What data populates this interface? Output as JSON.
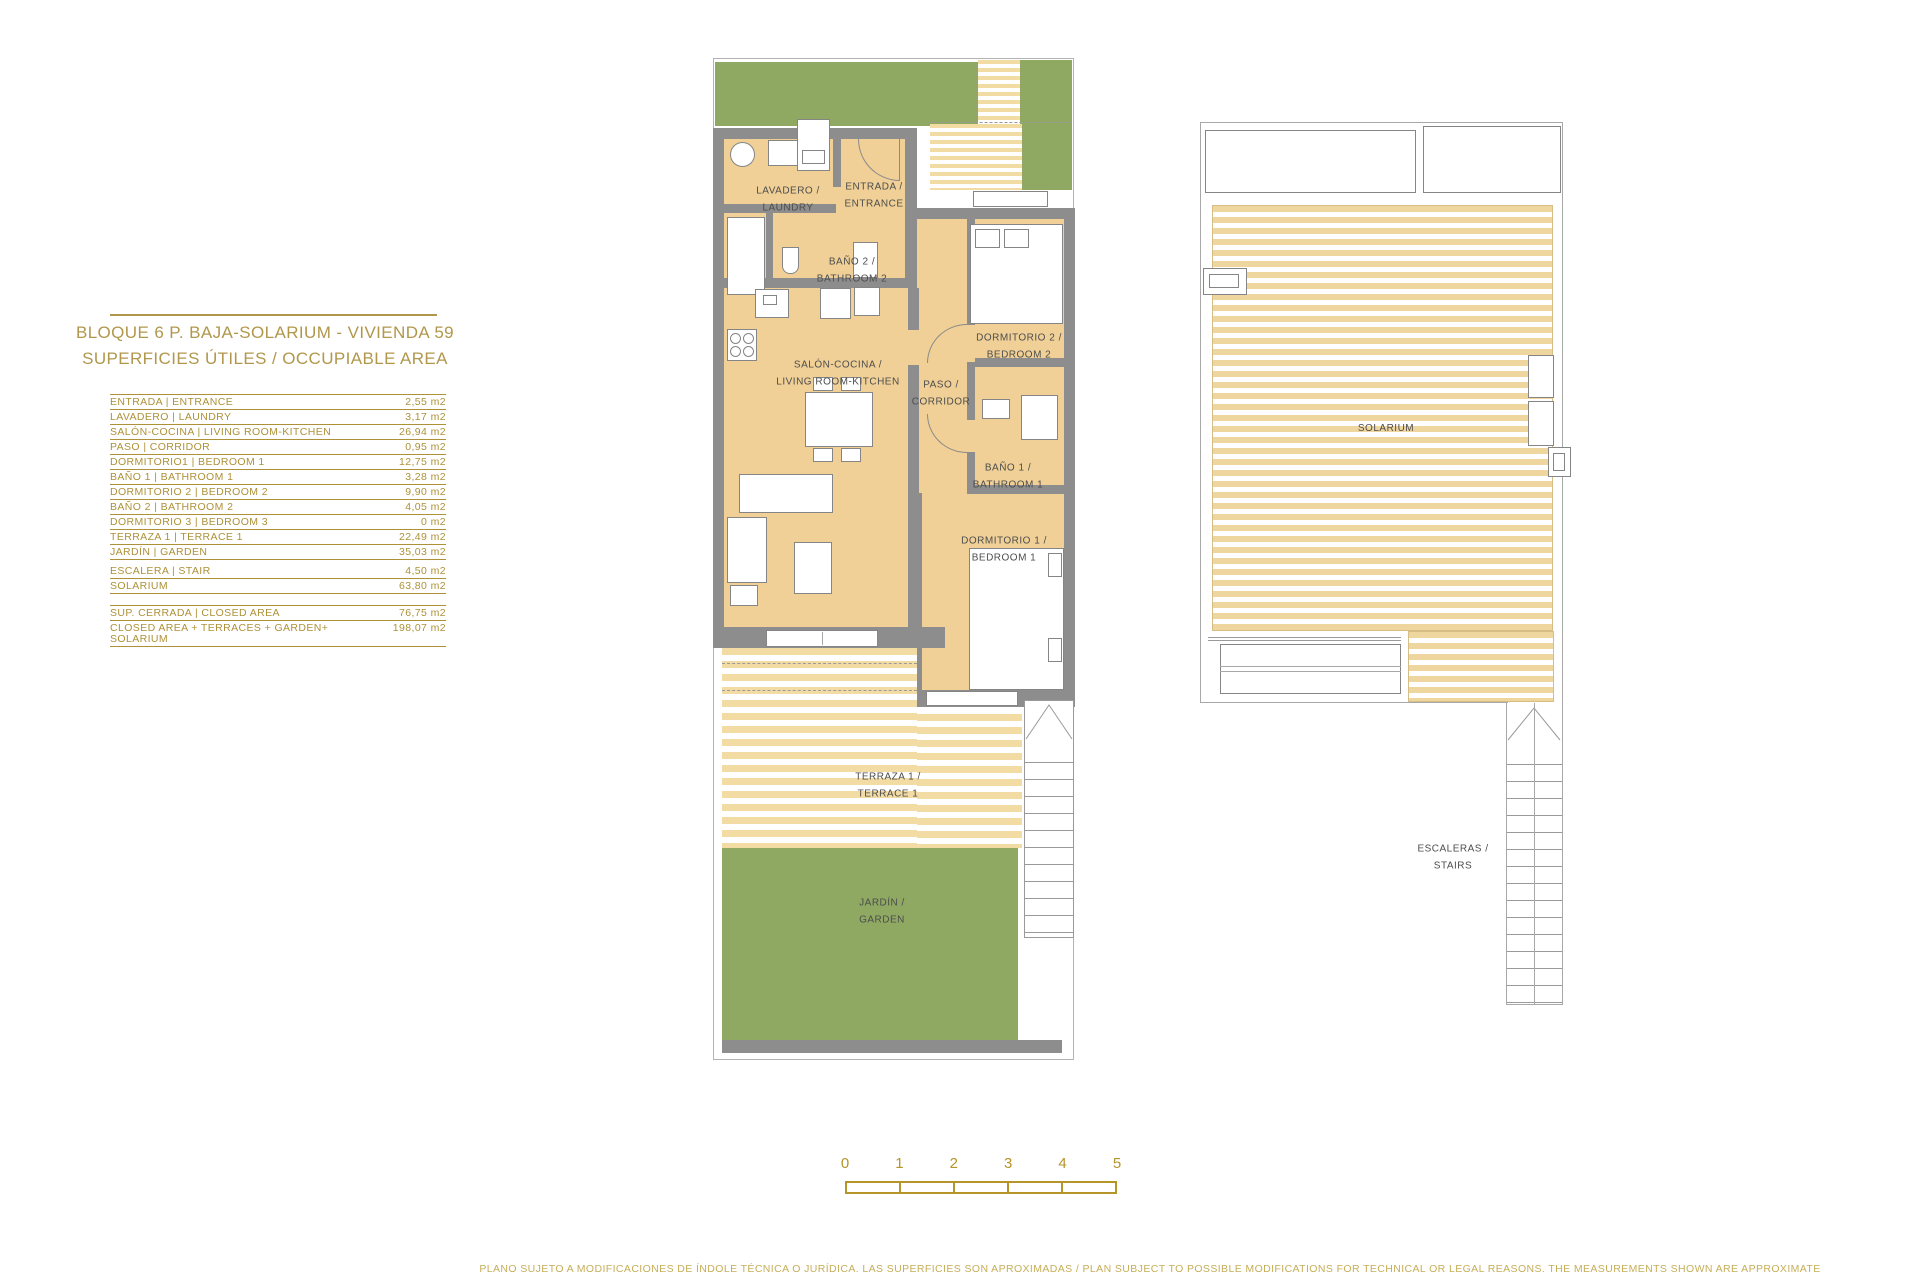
{
  "colors": {
    "gold_title": "#b1974b",
    "gold_table": "#ad9138",
    "gold_scale": "#b5942a",
    "gold_disclaimer": "#c6ae58",
    "wall_gray": "#8d8d8d",
    "floor_tan": "#f0d096",
    "garden_green": "#8fa963",
    "stripe_tan": "#f3dba4",
    "label_gray": "#4d4d4d"
  },
  "doc": {
    "title_line1": "BLOQUE 6 P. BAJA-SOLARIUM - VIVIENDA 59",
    "title_line2": "SUPERFICIES ÚTILES / OCCUPIABLE AREA",
    "disclaimer": "PLANO SUJETO A MODIFICACIONES DE ÍNDOLE TÉCNICA O JURÍDICA. LAS SUPERFICIES SON APROXIMADAS / PLAN SUBJECT TO POSSIBLE MODIFICATIONS FOR TECHNICAL OR LEGAL REASONS. THE MEASUREMENTS SHOWN ARE APPROXIMATE"
  },
  "area_table": {
    "rows": [
      {
        "label": "ENTRADA | ENTRANCE",
        "value": "2,55 m2"
      },
      {
        "label": "LAVADERO | LAUNDRY",
        "value": "3,17 m2"
      },
      {
        "label": "SALÓN-COCINA | LIVING ROOM-KITCHEN",
        "value": "26,94 m2"
      },
      {
        "label": "PASO | CORRIDOR",
        "value": "0,95 m2"
      },
      {
        "label": "DORMITORIO1 | BEDROOM 1",
        "value": "12,75 m2"
      },
      {
        "label": "BAÑO 1 | BATHROOM 1",
        "value": "3,28 m2"
      },
      {
        "label": "DORMITORIO 2 | BEDROOM 2",
        "value": "9,90 m2"
      },
      {
        "label": "BAÑO 2 | BATHROOM 2",
        "value": "4,05 m2"
      },
      {
        "label": "DORMITORIO 3 | BEDROOM 3",
        "value": "0 m2"
      },
      {
        "label": "TERRAZA 1 | TERRACE 1",
        "value": "22,49 m2"
      },
      {
        "label": "JARDÍN | GARDEN",
        "value": "35,03 m2"
      },
      {
        "label": "ESCALERA | STAIR",
        "value": "4,50 m2"
      },
      {
        "label": "SOLARIUM",
        "value": "63,80 m2"
      }
    ],
    "summary_rows": [
      {
        "label": "SUP. CERRADA | CLOSED AREA",
        "value": "76,75 m2"
      },
      {
        "label": "CLOSED AREA + TERRACES + GARDEN+ SOLARIUM",
        "value": "198,07 m2"
      }
    ]
  },
  "floor_plan": {
    "lavadero": "LAVADERO /\nLAUNDRY",
    "entrada": "ENTRADA /\nENTRANCE",
    "bano2": "BAÑO 2 /\nBATHROOM 2",
    "salon": "SALÓN-COCINA /\nLIVING ROOM-KITCHEN",
    "paso": "PASO /\nCORRIDOR",
    "dormitorio2": "DORMITORIO 2 /\nBEDROOM 2",
    "bano1": "BAÑO 1 /\nBATHROOM 1",
    "dormitorio1": "DORMITORIO 1 /\nBEDROOM 1",
    "terraza": "TERRAZA 1 /\nTERRACE 1",
    "jardin": "JARDÍN /\nGARDEN"
  },
  "solarium_plan": {
    "solarium": "SOLARIUM",
    "escaleras": "ESCALERAS /\nSTAIRS"
  },
  "scale_bar": {
    "ticks": [
      "0",
      "1",
      "2",
      "3",
      "4",
      "5"
    ]
  }
}
